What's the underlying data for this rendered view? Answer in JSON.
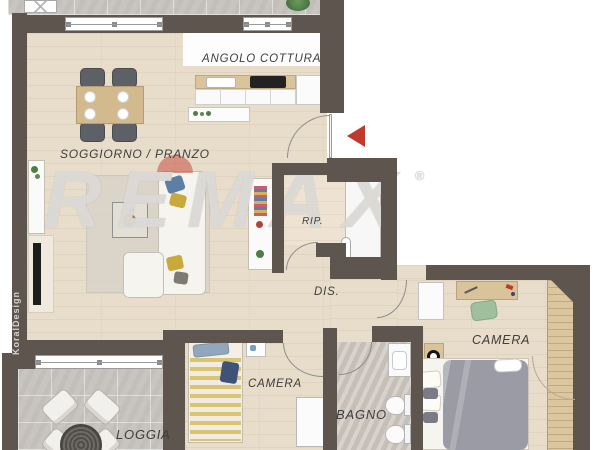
{
  "plan": {
    "watermark": {
      "brand": "REMAX",
      "registered": "®"
    },
    "credit": "KoralDesign",
    "labels": {
      "kitchen": "ANGOLO COTTURA",
      "living": "SOGGIORNO / PRANZO",
      "storage": "RIP.",
      "hall": "DIS.",
      "bedroom_master": "CAMERA",
      "bedroom_second": "CAMERA",
      "bath": "BAGNO",
      "loggia": "LOGGIA"
    },
    "colors": {
      "wall": "#5e564e",
      "wood_floor": "#e8ddca",
      "tile_floor": "#c8c4bf",
      "bath_floor": "#cdc6bf",
      "entrance_arrow": "#bf3a2c",
      "watermark_gray": "#dddbd8",
      "balloon_red": "#c64e42",
      "counter_wood": "#d9c49c",
      "duvet_gray": "#9b9ba5",
      "blanket_stripe_yellow": "#d9c474",
      "chair_green": "#9fbf9d"
    }
  }
}
